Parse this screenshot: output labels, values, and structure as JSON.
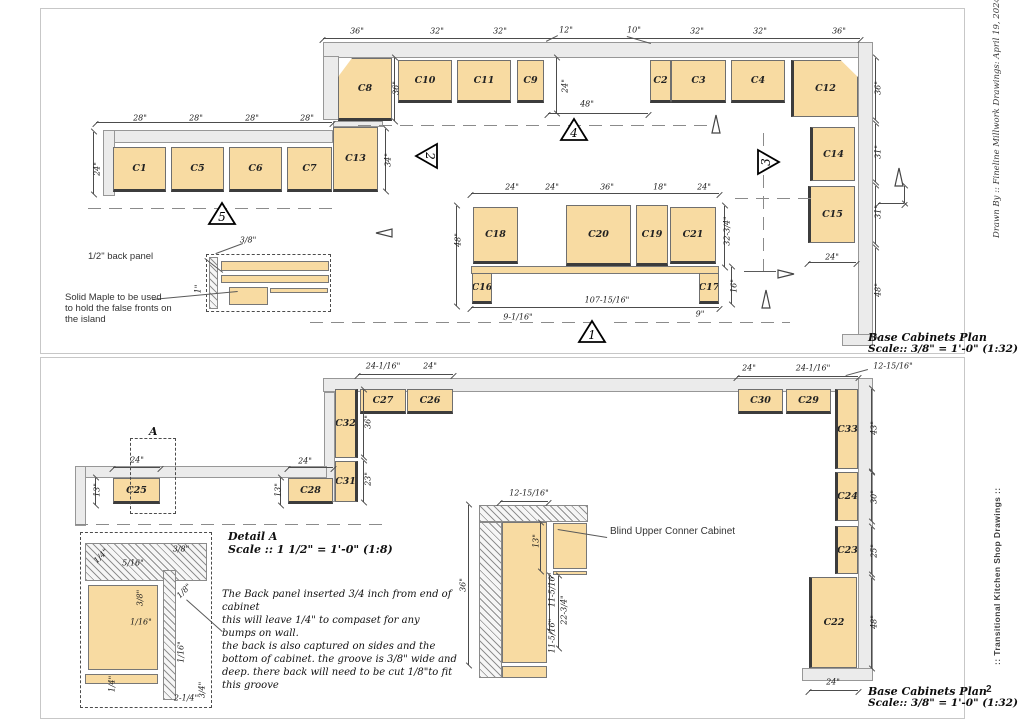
{
  "meta": {
    "page_number": "2"
  },
  "margins": {
    "drawn_by": "Drawn By :: Fineline Millwork Drawings:  April 19, 2024 ::",
    "series": "::  Transitional Kitchen Shop Drawings  ::"
  },
  "titles": {
    "plan": "Base Cabinets Plan",
    "scale": "Scale:: 3/8\" = 1'-0\" (1:32)"
  },
  "colors": {
    "cabinet": "#f8dba2",
    "wall": "#ebebeb",
    "line": "#4c4c4c",
    "dash": "#8b8b8b"
  },
  "sheets": [
    {
      "frame": {
        "x": 40,
        "y": 8,
        "w": 925,
        "h": 346
      },
      "walls": [
        [
          323,
          42,
          537,
          16
        ],
        [
          323,
          56,
          16,
          64
        ],
        [
          333,
          121,
          50,
          6
        ],
        [
          103,
          130,
          230,
          13
        ],
        [
          103,
          130,
          12,
          66
        ],
        [
          858,
          42,
          15,
          294
        ],
        [
          842,
          334,
          31,
          12
        ]
      ],
      "cabinets": [
        {
          "l": "C8",
          "x": 338,
          "y": 58,
          "w": 54,
          "h": 63,
          "f": "b",
          "ch": "tl"
        },
        {
          "l": "C10",
          "x": 398,
          "y": 60,
          "w": 54,
          "h": 43,
          "f": "b"
        },
        {
          "l": "C11",
          "x": 457,
          "y": 60,
          "w": 54,
          "h": 43,
          "f": "b"
        },
        {
          "l": "C9",
          "x": 517,
          "y": 60,
          "w": 27,
          "h": 43,
          "f": "b"
        },
        {
          "l": "C2",
          "x": 650,
          "y": 60,
          "w": 21,
          "h": 43,
          "f": "b"
        },
        {
          "l": "C3",
          "x": 671,
          "y": 60,
          "w": 55,
          "h": 43,
          "f": "b"
        },
        {
          "l": "C4",
          "x": 731,
          "y": 60,
          "w": 54,
          "h": 43,
          "f": "b"
        },
        {
          "l": "C12",
          "x": 791,
          "y": 60,
          "w": 67,
          "h": 57,
          "f": "l",
          "ch": "tr"
        },
        {
          "l": "C13",
          "x": 333,
          "y": 127,
          "w": 45,
          "h": 65,
          "f": "b"
        },
        {
          "l": "C1",
          "x": 113,
          "y": 147,
          "w": 53,
          "h": 45,
          "f": "b"
        },
        {
          "l": "C5",
          "x": 171,
          "y": 147,
          "w": 53,
          "h": 45,
          "f": "b"
        },
        {
          "l": "C6",
          "x": 229,
          "y": 147,
          "w": 53,
          "h": 45,
          "f": "b"
        },
        {
          "l": "C7",
          "x": 287,
          "y": 147,
          "w": 45,
          "h": 45,
          "f": "b"
        },
        {
          "l": "C14",
          "x": 810,
          "y": 127,
          "w": 45,
          "h": 54,
          "f": "l"
        },
        {
          "l": "C15",
          "x": 808,
          "y": 186,
          "w": 47,
          "h": 57,
          "f": "l"
        },
        {
          "l": "C18",
          "x": 473,
          "y": 207,
          "w": 45,
          "h": 57,
          "f": "b"
        },
        {
          "l": "C20",
          "x": 566,
          "y": 205,
          "w": 65,
          "h": 61,
          "f": "b"
        },
        {
          "l": "C19",
          "x": 636,
          "y": 205,
          "w": 32,
          "h": 61,
          "f": "b"
        },
        {
          "l": "C21",
          "x": 670,
          "y": 207,
          "w": 46,
          "h": 57,
          "f": "b"
        },
        {
          "l": "C16",
          "x": 472,
          "y": 273,
          "w": 20,
          "h": 31,
          "f": "b"
        },
        {
          "l": "C17",
          "x": 699,
          "y": 273,
          "w": 20,
          "h": 31,
          "f": "b"
        }
      ],
      "strips": [
        [
          471,
          266,
          248,
          8
        ],
        [
          221,
          261,
          108,
          10
        ],
        [
          221,
          275,
          108,
          8
        ],
        [
          229,
          287,
          39,
          18
        ],
        [
          270,
          288,
          58,
          5
        ]
      ],
      "hatches": [
        [
          209,
          257,
          9,
          52
        ]
      ],
      "dashrects": [
        [
          206,
          254,
          125,
          58
        ]
      ],
      "dims": [
        [
          "36\"",
          357,
          31
        ],
        [
          "32\"",
          437,
          31
        ],
        [
          "32\"",
          500,
          31
        ],
        [
          "12\"",
          566,
          30
        ],
        [
          "10\"",
          634,
          30
        ],
        [
          "32\"",
          697,
          31
        ],
        [
          "32\"",
          760,
          31
        ],
        [
          "36\"",
          839,
          31
        ],
        [
          "28\"",
          140,
          118
        ],
        [
          "28\"",
          196,
          118
        ],
        [
          "28\"",
          252,
          118
        ],
        [
          "28\"",
          307,
          118
        ],
        [
          "24\"",
          97,
          169,
          1
        ],
        [
          "34\"",
          388,
          160,
          1
        ],
        [
          "36\"",
          396,
          88,
          1
        ],
        [
          "24\"",
          565,
          86,
          1
        ],
        [
          "48\"",
          587,
          104
        ],
        [
          "36\"",
          878,
          88,
          1
        ],
        [
          "31\"",
          878,
          152,
          1
        ],
        [
          "31\"",
          878,
          212,
          1
        ],
        [
          "48\"",
          878,
          290,
          1
        ],
        [
          "24\"",
          832,
          257
        ],
        [
          "24\"",
          512,
          187
        ],
        [
          "24\"",
          552,
          187
        ],
        [
          "36\"",
          607,
          187
        ],
        [
          "18\"",
          660,
          187
        ],
        [
          "24\"",
          704,
          187
        ],
        [
          "48\"",
          458,
          240,
          1
        ],
        [
          "32-3/4\"",
          727,
          231,
          1
        ],
        [
          "16\"",
          734,
          286,
          1
        ],
        [
          "107-15/16\"",
          607,
          300
        ],
        [
          "9-1/16\"",
          518,
          317
        ],
        [
          "9\"",
          700,
          314
        ],
        [
          "3/8\"",
          248,
          240
        ],
        [
          "1\"",
          198,
          289,
          1
        ]
      ],
      "dimlines_h": [
        [
          323,
          38,
          537
        ],
        [
          96,
          122,
          236
        ],
        [
          548,
          113,
          100
        ],
        [
          471,
          193,
          248
        ],
        [
          471,
          307,
          248
        ],
        [
          808,
          262,
          48
        ],
        [
          878,
          203,
          26
        ]
      ],
      "dimlines_v": [
        [
          93,
          132,
          62
        ],
        [
          394,
          58,
          63
        ],
        [
          385,
          129,
          62
        ],
        [
          556,
          58,
          55
        ],
        [
          875,
          58,
          62
        ],
        [
          875,
          124,
          58
        ],
        [
          875,
          186,
          58
        ],
        [
          875,
          248,
          88
        ],
        [
          456,
          206,
          100
        ],
        [
          724,
          206,
          61
        ],
        [
          731,
          267,
          37
        ],
        [
          904,
          186,
          17
        ]
      ],
      "dashes_h": [
        [
          358,
          125,
          352
        ],
        [
          88,
          208,
          246
        ],
        [
          735,
          198,
          76
        ],
        [
          310,
          322,
          280
        ],
        [
          614,
          322,
          176
        ]
      ],
      "dashes_v": [
        [
          763,
          133,
          140
        ]
      ],
      "markers": [
        {
          "n": "5",
          "x": 207,
          "y": 200,
          "d": "up"
        },
        {
          "n": "2",
          "x": 413,
          "y": 141,
          "d": "left"
        },
        {
          "n": "4",
          "x": 559,
          "y": 116,
          "d": "up"
        },
        {
          "n": "3",
          "x": 756,
          "y": 147,
          "d": "right"
        },
        {
          "n": "1",
          "x": 577,
          "y": 318,
          "d": "up"
        }
      ],
      "arrows": [
        {
          "t": "left",
          "x": 374,
          "y": 224
        },
        {
          "t": "right",
          "x": 776,
          "y": 265
        },
        {
          "t": "up",
          "x": 710,
          "y": 113
        },
        {
          "t": "up",
          "x": 893,
          "y": 166
        },
        {
          "t": "up",
          "x": 760,
          "y": 288
        }
      ],
      "leaders": [
        [
          205,
          258,
          223,
          272
        ],
        [
          243,
          244,
          216,
          254
        ],
        [
          152,
          299,
          238,
          291
        ],
        [
          558,
          36,
          546,
          42
        ],
        [
          627,
          36,
          651,
          43
        ],
        [
          744,
          271,
          776,
          271
        ]
      ],
      "notes": [
        {
          "t": "1/2\" back panel",
          "x": 88,
          "y": 251,
          "c": "sans"
        },
        {
          "t": "Solid Maple to be used\nto hold the false fronts on\nthe island",
          "x": 65,
          "y": 292,
          "c": "sans"
        }
      ],
      "title_xy": [
        868,
        331
      ]
    },
    {
      "frame": {
        "x": 40,
        "y": 357,
        "w": 925,
        "h": 362
      },
      "walls": [
        [
          323,
          378,
          537,
          14
        ],
        [
          324,
          392,
          11,
          110
        ],
        [
          858,
          378,
          15,
          292
        ],
        [
          802,
          668,
          71,
          13
        ],
        [
          75,
          466,
          252,
          12
        ],
        [
          75,
          466,
          11,
          60
        ]
      ],
      "cabinets": [
        {
          "l": "C32",
          "x": 335,
          "y": 389,
          "w": 23,
          "h": 69,
          "f": "r"
        },
        {
          "l": "C27",
          "x": 360,
          "y": 389,
          "w": 46,
          "h": 25,
          "f": "b"
        },
        {
          "l": "C26",
          "x": 407,
          "y": 389,
          "w": 46,
          "h": 25,
          "f": "b"
        },
        {
          "l": "C30",
          "x": 738,
          "y": 389,
          "w": 45,
          "h": 25,
          "f": "b"
        },
        {
          "l": "C29",
          "x": 786,
          "y": 389,
          "w": 45,
          "h": 25,
          "f": "b"
        },
        {
          "l": "C33",
          "x": 835,
          "y": 389,
          "w": 23,
          "h": 80,
          "f": "l"
        },
        {
          "l": "C24",
          "x": 835,
          "y": 472,
          "w": 23,
          "h": 49,
          "f": "l"
        },
        {
          "l": "C23",
          "x": 835,
          "y": 526,
          "w": 23,
          "h": 48,
          "f": "l"
        },
        {
          "l": "C22",
          "x": 809,
          "y": 577,
          "w": 48,
          "h": 91,
          "f": "l"
        },
        {
          "l": "C31",
          "x": 335,
          "y": 461,
          "w": 23,
          "h": 41,
          "f": "r"
        },
        {
          "l": "C28",
          "x": 288,
          "y": 478,
          "w": 45,
          "h": 26,
          "f": "b"
        },
        {
          "l": "C25",
          "x": 113,
          "y": 478,
          "w": 47,
          "h": 26,
          "f": "b"
        }
      ],
      "strips": [
        [
          502,
          522,
          45,
          141
        ],
        [
          502,
          666,
          45,
          12
        ],
        [
          553,
          523,
          34,
          46
        ],
        [
          553,
          571,
          34,
          4
        ],
        [
          88,
          585,
          70,
          85
        ],
        [
          85,
          674,
          73,
          10
        ]
      ],
      "hatches": [
        [
          479,
          505,
          109,
          17
        ],
        [
          479,
          522,
          23,
          156
        ],
        [
          85,
          543,
          122,
          38
        ],
        [
          163,
          570,
          13,
          130
        ]
      ],
      "dashrects": [
        [
          80,
          532,
          132,
          176
        ],
        [
          130,
          438,
          46,
          76
        ]
      ],
      "dims": [
        [
          "24-1/16\"",
          383,
          366
        ],
        [
          "24\"",
          430,
          366
        ],
        [
          "24\"",
          749,
          368
        ],
        [
          "24-1/16\"",
          813,
          368
        ],
        [
          "12-15/16\"",
          893,
          366
        ],
        [
          "36\"",
          368,
          422,
          1
        ],
        [
          "23\"",
          368,
          479,
          1
        ],
        [
          "24\"",
          137,
          460
        ],
        [
          "13\"",
          97,
          490,
          1
        ],
        [
          "24\"",
          305,
          461
        ],
        [
          "13\"",
          278,
          490,
          1
        ],
        [
          "43\"",
          874,
          428,
          1
        ],
        [
          "30\"",
          874,
          497,
          1
        ],
        [
          "25\"",
          874,
          551,
          1
        ],
        [
          "48\"",
          874,
          622,
          1
        ],
        [
          "24\"",
          833,
          682
        ],
        [
          "12-15/16\"",
          529,
          493
        ],
        [
          "36\"",
          463,
          585,
          1
        ],
        [
          "13\"",
          536,
          541,
          1
        ],
        [
          "11-5/16\"",
          552,
          590,
          1
        ],
        [
          "22-3/4\"",
          564,
          610,
          1
        ],
        [
          "11-5/16\"",
          552,
          636,
          1
        ],
        [
          "1/4\"",
          101,
          556,
          2
        ],
        [
          "5/16\"",
          133,
          563
        ],
        [
          "3/8\"",
          181,
          549
        ],
        [
          "3/8\"",
          140,
          598,
          1
        ],
        [
          "1/8\"",
          184,
          591,
          2
        ],
        [
          "1/16\"",
          141,
          622
        ],
        [
          "1/16\"",
          181,
          652,
          1
        ],
        [
          "1/4\"",
          112,
          684,
          1
        ],
        [
          "2-1/4\"",
          186,
          698
        ],
        [
          "3/4\"",
          202,
          690,
          1
        ]
      ],
      "dimlines_h": [
        [
          358,
          374,
          95
        ],
        [
          737,
          376,
          121
        ],
        [
          113,
          467,
          47
        ],
        [
          288,
          467,
          45
        ],
        [
          809,
          690,
          49
        ],
        [
          500,
          501,
          48
        ]
      ],
      "dimlines_v": [
        [
          363,
          390,
          67
        ],
        [
          363,
          461,
          41
        ],
        [
          95,
          478,
          27
        ],
        [
          280,
          478,
          27
        ],
        [
          871,
          389,
          82
        ],
        [
          871,
          473,
          48
        ],
        [
          871,
          527,
          47
        ],
        [
          871,
          578,
          90
        ],
        [
          468,
          505,
          160
        ],
        [
          540,
          523,
          48
        ],
        [
          549,
          576,
          55
        ],
        [
          558,
          576,
          72
        ]
      ],
      "dashes_h": [
        [
          75,
          524,
          315
        ]
      ],
      "dashes_v": [],
      "markers": [],
      "arrows": [],
      "leaders": [
        [
          607,
          538,
          558,
          530
        ],
        [
          868,
          370,
          846,
          376
        ],
        [
          222,
          632,
          186,
          600
        ]
      ],
      "notes": [
        {
          "t": "Blind Upper Conner Cabinet",
          "x": 610,
          "y": 526,
          "c": "sans10"
        },
        {
          "t": "A",
          "x": 149,
          "y": 425,
          "c": "dtitle"
        },
        {
          "t": "Detail A",
          "x": 228,
          "y": 530,
          "c": "dtitle"
        },
        {
          "t": "Scale :: 1 1/2\" = 1'-0\" (1:8)",
          "x": 228,
          "y": 543,
          "c": "dtitle"
        },
        {
          "t": "The Back panel inserted 3/4 inch from end of cabinet\nthis will leave  1/4\" to compaset for any\nbumps on wall.\nthe back is also captured on sides and the\nbottom of cabinet. the groove is 3/8\" wide and\ndeep. there back will need to be cut 1/8\"to fit\nthis groove",
          "x": 222,
          "y": 588,
          "c": "para"
        }
      ],
      "title_xy": [
        868,
        683
      ]
    }
  ]
}
